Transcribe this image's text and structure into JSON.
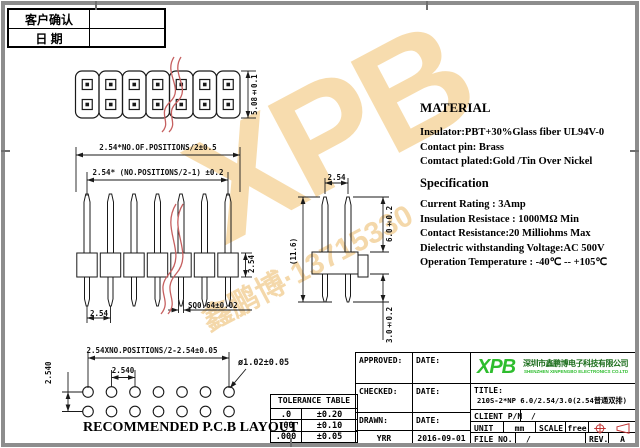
{
  "sheet": {
    "bg": "#ffffff",
    "frame_color": "#8d8d8d",
    "line_color": "#1a1a1a",
    "break_line_color": "#c66060"
  },
  "watermark": {
    "logo": "XPB",
    "logo_color": "#f6d7a0",
    "text": "鑫鹏博·13715330",
    "text_color": "#f2cf96"
  },
  "confirm": {
    "rows": [
      {
        "label": "客户确认",
        "value": ""
      },
      {
        "label": "日  期",
        "value": ""
      }
    ]
  },
  "views": {
    "positions": 7,
    "pin_rows": 2
  },
  "material": {
    "heading": "MATERIAL",
    "lines": [
      "Insulator:PBT+30%Glass fiber UL94V-0",
      "Contact pin: Brass",
      "Comtact plated:Gold /Tin  Over Nickel"
    ]
  },
  "spec": {
    "heading": "Specification",
    "lines": [
      "Current Rating : 3Amp",
      "Insulation Resistace : 1000MΩ Min",
      "Contact Resistance:20 Milliohms Max",
      "Dielectric  withstanding Voltage:AC 500V",
      "Operation Temperature  : -40℃  --  +105℃"
    ]
  },
  "dims": {
    "overall_width": "2.54*NO.OF.POSITIONS/2±0.5",
    "pin_span": "2.54* (NO.POSITIONS/2-1) ±0.2",
    "body_height": "5.08±0.1",
    "pin_pitch": "2.54",
    "pin_square": "SQ0.64±0.02",
    "body_thickness": "2.54",
    "row_pitch": "2.54",
    "overall_height": "(11.6)",
    "mating_length": "6.0±0.2",
    "tail_length": "3.0±0.2"
  },
  "pcb": {
    "span": "2.54XNO.POSITIONS/2-2.54±0.05",
    "pitch": "2.540",
    "row_pitch": "2.540",
    "hole": "ø1.02±0.05",
    "caption": "RECOMMENDED P.C.B LAYOUT"
  },
  "tolerance": {
    "title": "TOLERANCE TABLE",
    "rows": [
      [
        ".0",
        "±0.20"
      ],
      [
        ".00",
        "±0.10"
      ],
      [
        ".000",
        "±0.05"
      ]
    ]
  },
  "titleblock": {
    "approved_label": "APPROVED:",
    "checked_label": "CHECKED:",
    "drawn_label": "DRAWN:",
    "drawn_value": "YRR",
    "date_label": "DATE:",
    "drawn_date": "2016-09-01",
    "logo": "XPB",
    "logo_color": "#2ebd2e",
    "company_cn": "深圳市鑫鹏博电子科技有限公司",
    "company_en": "SHENZHEN XINPENGBO ELECTRONICS CO.LTD",
    "title_label": "TITLE:",
    "title_value": "210S-2*NP 6.0/2.54/3.0(2.54普通双排)",
    "client_label": "CLIENT P/N",
    "client_value": "/",
    "unit_label": "UNIT",
    "unit_value": "mm",
    "scale_label": "SCALE",
    "scale_value": "free",
    "file_label": "FILE NO.",
    "file_value": "/",
    "rev_label": "REV.",
    "rev_value": "A"
  }
}
